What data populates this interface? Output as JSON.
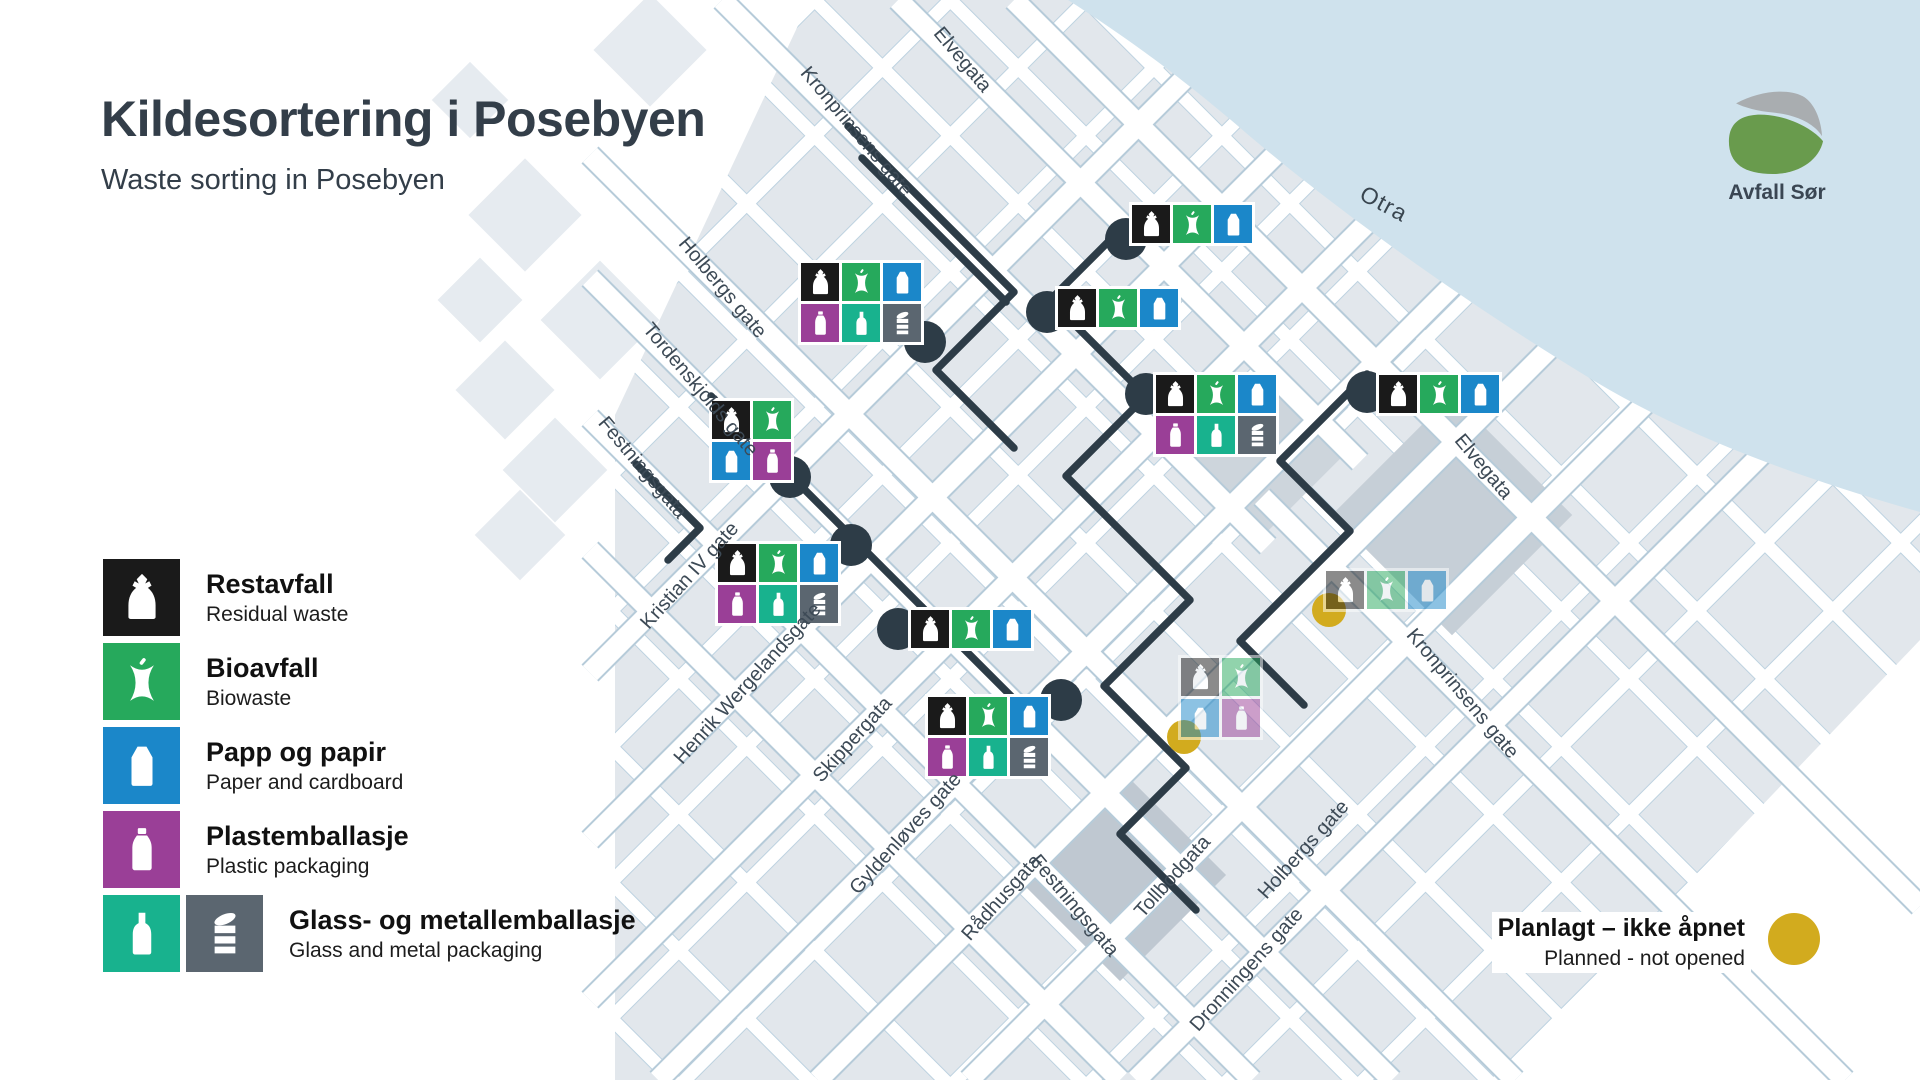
{
  "page": {
    "title": "Kildesortering i Posebyen",
    "subtitle": "Waste sorting in Posebyen"
  },
  "logo": {
    "name": "Avfall Sør"
  },
  "colors": {
    "navy_marker": "#2d3c47",
    "planned_yellow": "#d2ab1e",
    "river": "#cfe2ed",
    "title_text": "#333e49"
  },
  "tile_types": {
    "black": {
      "color": "#1a1a1a",
      "icon": "bag",
      "name": "restavfall"
    },
    "green": {
      "color": "#26a95c",
      "icon": "apple",
      "name": "bioavfall"
    },
    "blue": {
      "color": "#1b87c9",
      "icon": "carton",
      "name": "papp-og-papir"
    },
    "purple": {
      "color": "#9a3f97",
      "icon": "plastic",
      "name": "plastemballasje"
    },
    "teal": {
      "color": "#18b28e",
      "icon": "glass",
      "name": "glassemballasje"
    },
    "gray": {
      "color": "#5b6670",
      "icon": "can",
      "name": "metallemballasje"
    }
  },
  "legend": {
    "items": [
      {
        "title": "Restavfall",
        "subtitle": "Residual waste",
        "types": [
          "black"
        ]
      },
      {
        "title": "Bioavfall",
        "subtitle": "Biowaste",
        "types": [
          "green"
        ]
      },
      {
        "title": "Papp og papir",
        "subtitle": "Paper and cardboard",
        "types": [
          "blue"
        ]
      },
      {
        "title": "Plastemballasje",
        "subtitle": "Plastic packaging",
        "types": [
          "purple"
        ]
      },
      {
        "title": "Glass- og metallemballasje",
        "subtitle": "Glass and metal packaging",
        "types": [
          "teal",
          "gray"
        ]
      }
    ]
  },
  "planned": {
    "title": "Planlagt – ikke åpnet",
    "subtitle": "Planned - not opened"
  },
  "map": {
    "river_label": {
      "text": "Otra",
      "x": 1384,
      "y": 204,
      "rot": 28
    },
    "street_labels": [
      {
        "text": "Elvegata",
        "x": 962,
        "y": 60,
        "rot": 50
      },
      {
        "text": "Kronprinsens gate",
        "x": 856,
        "y": 132,
        "rot": 50
      },
      {
        "text": "Holbergs gate",
        "x": 722,
        "y": 288,
        "rot": 50
      },
      {
        "text": "Tordenskjolds gate",
        "x": 700,
        "y": 390,
        "rot": 50
      },
      {
        "text": "Festningsgata",
        "x": 642,
        "y": 468,
        "rot": 50
      },
      {
        "text": "Kristian IV gate",
        "x": 690,
        "y": 576,
        "rot": -48
      },
      {
        "text": "Henrik Wergelandsgate",
        "x": 748,
        "y": 684,
        "rot": -48
      },
      {
        "text": "Skippergata",
        "x": 853,
        "y": 740,
        "rot": -48
      },
      {
        "text": "Gyldenløves gate",
        "x": 906,
        "y": 834,
        "rot": -48
      },
      {
        "text": "Rådhusgata",
        "x": 1002,
        "y": 898,
        "rot": -48
      },
      {
        "text": "Festningsgata",
        "x": 1074,
        "y": 906,
        "rot": 50
      },
      {
        "text": "Tollbodgata",
        "x": 1173,
        "y": 877,
        "rot": -48
      },
      {
        "text": "Dronningens gate",
        "x": 1247,
        "y": 970,
        "rot": -48
      },
      {
        "text": "Holbergs gate",
        "x": 1304,
        "y": 850,
        "rot": -48
      },
      {
        "text": "Kronprinsens gate",
        "x": 1462,
        "y": 694,
        "rot": 50
      },
      {
        "text": "Elvegata",
        "x": 1483,
        "y": 467,
        "rot": 50
      }
    ],
    "stations": [
      {
        "id": "st-1",
        "x": 1129,
        "y": 202,
        "cols": 3,
        "tiles": [
          "black",
          "green",
          "blue"
        ],
        "circle": {
          "x": 1126,
          "y": 239
        }
      },
      {
        "id": "st-2",
        "x": 798,
        "y": 260,
        "cols": 3,
        "tiles": [
          "black",
          "green",
          "blue",
          "purple",
          "teal",
          "gray"
        ],
        "circle": {
          "x": 925,
          "y": 342
        }
      },
      {
        "id": "st-3",
        "x": 1055,
        "y": 286,
        "cols": 3,
        "tiles": [
          "black",
          "green",
          "blue"
        ],
        "circle": {
          "x": 1047,
          "y": 312
        }
      },
      {
        "id": "st-4",
        "x": 1153,
        "y": 372,
        "cols": 3,
        "tiles": [
          "black",
          "green",
          "blue",
          "purple",
          "teal",
          "gray"
        ],
        "circle": {
          "x": 1146,
          "y": 394
        }
      },
      {
        "id": "st-5",
        "x": 1376,
        "y": 372,
        "cols": 3,
        "tiles": [
          "black",
          "green",
          "blue"
        ],
        "circle": {
          "x": 1367,
          "y": 392
        }
      },
      {
        "id": "st-6",
        "x": 709,
        "y": 398,
        "cols": 2,
        "tiles": [
          "black",
          "green",
          "blue",
          "purple"
        ],
        "circle": {
          "x": 790,
          "y": 477
        }
      },
      {
        "id": "st-7",
        "x": 715,
        "y": 541,
        "cols": 3,
        "tiles": [
          "black",
          "green",
          "blue",
          "purple",
          "teal",
          "gray"
        ],
        "circle": {
          "x": 851,
          "y": 545
        }
      },
      {
        "id": "st-8",
        "x": 908,
        "y": 607,
        "cols": 3,
        "tiles": [
          "black",
          "green",
          "blue"
        ],
        "circle": {
          "x": 898,
          "y": 629
        }
      },
      {
        "id": "st-9",
        "x": 925,
        "y": 694,
        "cols": 3,
        "tiles": [
          "black",
          "green",
          "blue",
          "purple",
          "teal",
          "gray"
        ],
        "circle": {
          "x": 1061,
          "y": 700
        }
      },
      {
        "id": "st-10",
        "x": 1323,
        "y": 568,
        "cols": 3,
        "tiles": [
          "black",
          "green",
          "blue"
        ],
        "faded": true,
        "circle": {
          "x": 1329,
          "y": 610,
          "planned": true
        }
      },
      {
        "id": "st-11",
        "x": 1178,
        "y": 655,
        "cols": 2,
        "tiles": [
          "black",
          "green",
          "blue",
          "purple"
        ],
        "faded": true,
        "circle": {
          "x": 1184,
          "y": 737,
          "planned": true
        }
      }
    ]
  }
}
